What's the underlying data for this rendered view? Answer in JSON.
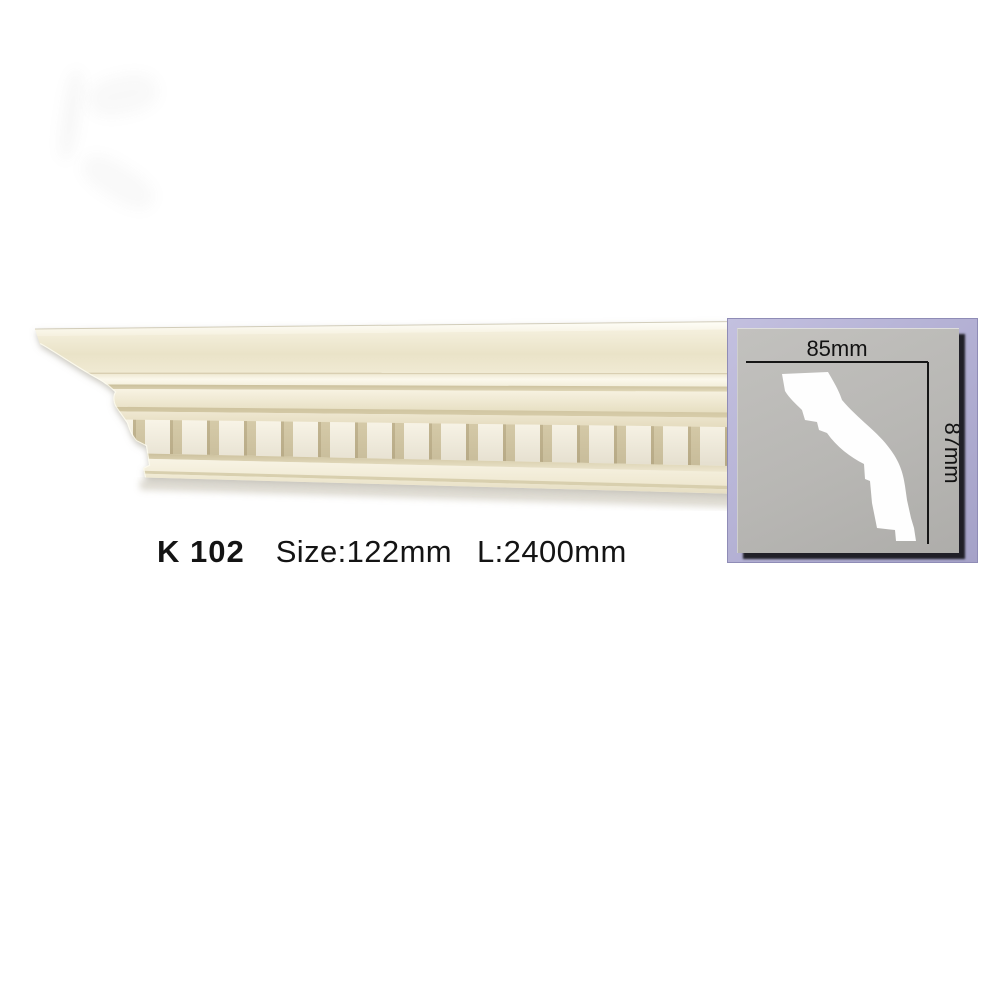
{
  "product_label": {
    "code": "K 102",
    "size": "Size:122mm",
    "length": "L:2400mm"
  },
  "profile_diagram": {
    "width_label": "85mm",
    "height_label": "87mm"
  },
  "colors": {
    "cream_base": "#f2ecd8",
    "cream_shadow_groove": "#d5caa8",
    "dentil_block": "#f9f5e8",
    "panel_lavender": "#b5b2d5",
    "panel_gray": "#b8b7b4",
    "text_black": "#141414"
  }
}
